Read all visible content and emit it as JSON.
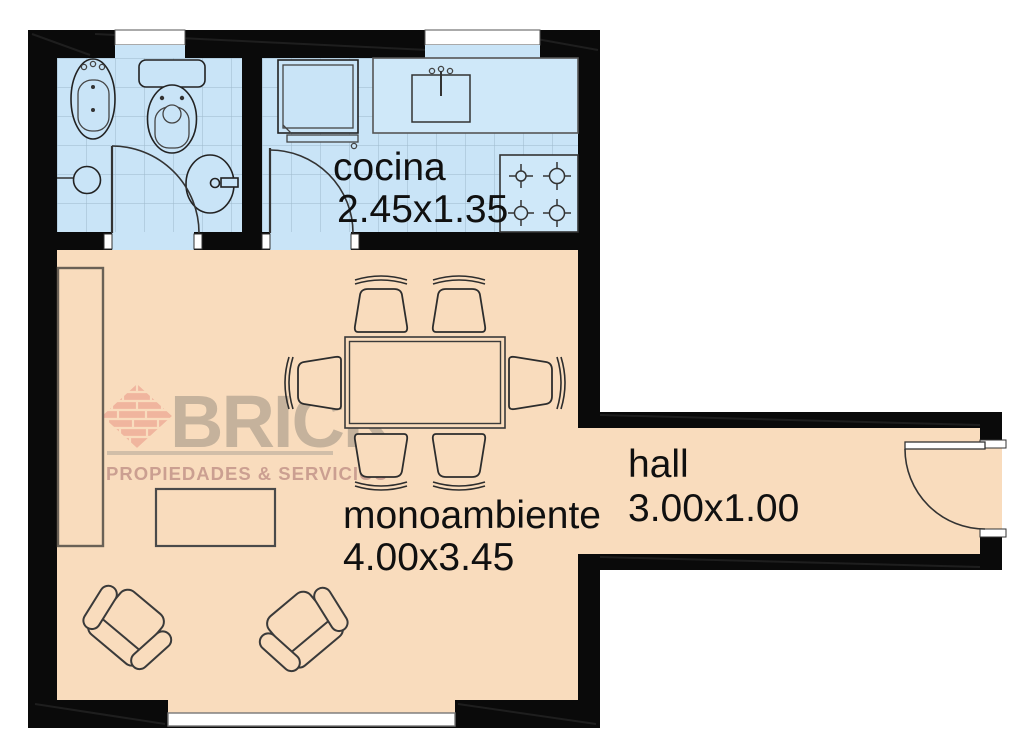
{
  "plan": {
    "type": "apartment-floor-plan",
    "rooms": {
      "cocina": {
        "label": "cocina",
        "dims": "2.45x1.35"
      },
      "monoambiente": {
        "label": "monoambiente",
        "dims": "4.00x3.45"
      },
      "hall": {
        "label": "hall",
        "dims": "3.00x1.00"
      }
    },
    "watermark": {
      "brand": "BRICK",
      "tagline": "PROPIEDADES & SERVICIOS"
    },
    "colors": {
      "wall": "#0a0a0a",
      "tile_floor": "#c9e4f7",
      "tile_grid": "#9db9cb",
      "wood_floor": "#f9dcbd",
      "brand_brick_pink": "#eb9d8c",
      "watermark_gray": "#9b9082",
      "label_text": "#101010"
    }
  }
}
